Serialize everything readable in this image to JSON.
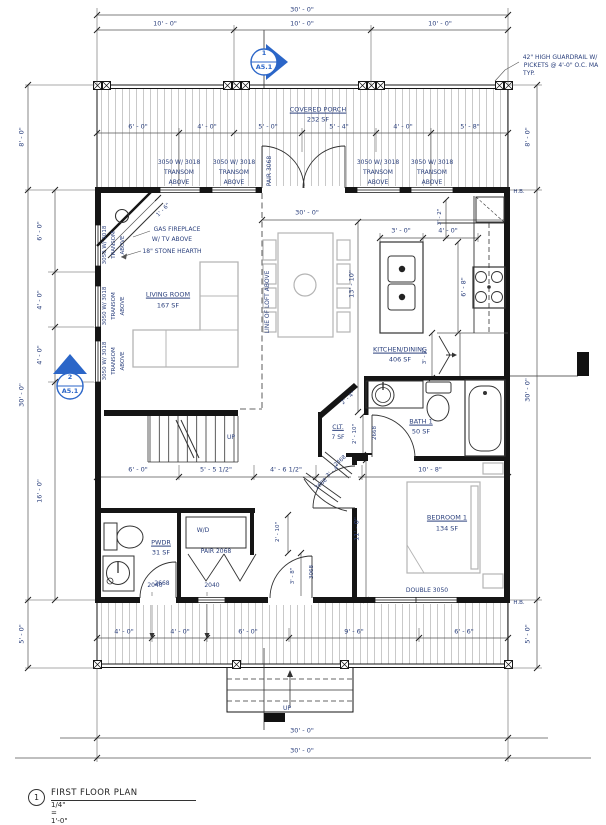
{
  "colors": {
    "annotation": "#2a3f7c",
    "marker_blue": "#2b66c8",
    "wall_black": "#151515",
    "furniture_gray": "#b4b4b4",
    "hatch_gray": "#a5a5a5"
  },
  "title_block": {
    "number": "1",
    "title": "FIRST FLOOR PLAN",
    "scale": "1/4\" = 1'-0\""
  },
  "section_markers": [
    {
      "number": "1",
      "sheet": "A5.1"
    },
    {
      "number": "2",
      "sheet": "A5.1"
    }
  ],
  "rooms": [
    {
      "name": "COVERED PORCH",
      "area": "232 SF"
    },
    {
      "name": "LIVING ROOM",
      "area": "167 SF"
    },
    {
      "name": "KITCHEN/DINING",
      "area": "406 SF"
    },
    {
      "name": "BATH 1",
      "area": "50 SF"
    },
    {
      "name": "CLT.",
      "area": "7 SF"
    },
    {
      "name": "PWDR",
      "area": "31 SF"
    },
    {
      "name": "BEDROOM 1",
      "area": "134 SF"
    }
  ],
  "labels": [
    {
      "n": "dim-top-overall",
      "t": "30' - 0\"",
      "x": 302,
      "y": 10
    },
    {
      "n": "dim-top-seg-1",
      "t": "10' - 0\"",
      "x": 165,
      "y": 24
    },
    {
      "n": "dim-top-seg-2",
      "t": "10' - 0\"",
      "x": 302,
      "y": 24
    },
    {
      "n": "dim-top-seg-3",
      "t": "10' - 0\"",
      "x": 440,
      "y": 24
    },
    {
      "n": "note-guardrail-1",
      "t": "42\" HIGH GUARDRAIL W/",
      "x": 560,
      "y": 58,
      "s": 6
    },
    {
      "n": "note-guardrail-2",
      "t": "PICKETS @ 4'-0\" O.C. MA",
      "x": 561,
      "y": 66,
      "s": 6
    },
    {
      "n": "note-guardrail-3",
      "t": "TYP.",
      "x": 529,
      "y": 74,
      "s": 6
    },
    {
      "n": "room-label-porch",
      "t": "COVERED PORCH",
      "x": 318,
      "y": 110,
      "u": 1
    },
    {
      "n": "room-area-porch",
      "t": "232 SF",
      "x": 318,
      "y": 120
    },
    {
      "n": "dim-porch-1",
      "t": "6' - 0\"",
      "x": 138,
      "y": 127
    },
    {
      "n": "dim-porch-2",
      "t": "4' - 0\"",
      "x": 207,
      "y": 127
    },
    {
      "n": "dim-porch-3",
      "t": "5' - 0\"",
      "x": 268,
      "y": 127
    },
    {
      "n": "dim-porch-4",
      "t": "5' - 4\"",
      "x": 339,
      "y": 127
    },
    {
      "n": "dim-porch-5",
      "t": "4' - 0\"",
      "x": 403,
      "y": 127
    },
    {
      "n": "dim-porch-6",
      "t": "5' - 8\"",
      "x": 470,
      "y": 127
    },
    {
      "n": "window-label-front-1a",
      "t": "3050 W/ 3018",
      "x": 179,
      "y": 163,
      "s": 6
    },
    {
      "n": "window-label-front-1b",
      "t": "TRANSOM",
      "x": 179,
      "y": 173,
      "s": 6
    },
    {
      "n": "window-label-front-1c",
      "t": "ABOVE",
      "x": 179,
      "y": 183,
      "s": 6
    },
    {
      "n": "window-label-front-2a",
      "t": "3050 W/ 3018",
      "x": 234,
      "y": 163,
      "s": 6
    },
    {
      "n": "window-label-front-2b",
      "t": "TRANSOM",
      "x": 234,
      "y": 173,
      "s": 6
    },
    {
      "n": "window-label-front-2c",
      "t": "ABOVE",
      "x": 234,
      "y": 183,
      "s": 6
    },
    {
      "n": "door-tag-pair-3068",
      "t": "PAIR 3068",
      "x": 270,
      "y": 171,
      "r": -90,
      "s": 6
    },
    {
      "n": "window-label-front-3a",
      "t": "3050 W/ 3018",
      "x": 378,
      "y": 163,
      "s": 6
    },
    {
      "n": "window-label-front-3b",
      "t": "TRANSOM",
      "x": 378,
      "y": 173,
      "s": 6
    },
    {
      "n": "window-label-front-3c",
      "t": "ABOVE",
      "x": 378,
      "y": 183,
      "s": 6
    },
    {
      "n": "window-label-front-4a",
      "t": "3050 W/ 3018",
      "x": 432,
      "y": 163,
      "s": 6
    },
    {
      "n": "window-label-front-4b",
      "t": "TRANSOM",
      "x": 432,
      "y": 173,
      "s": 6
    },
    {
      "n": "window-label-front-4c",
      "t": "ABOVE",
      "x": 432,
      "y": 183,
      "s": 6
    },
    {
      "n": "dim-left-porch",
      "t": "8' - 0\"",
      "x": 22,
      "y": 137,
      "r": -90
    },
    {
      "n": "dim-left-overall",
      "t": "30' - 0\"",
      "x": 22,
      "y": 395,
      "r": -90
    },
    {
      "n": "dim-left-deck",
      "t": "5' - 0\"",
      "x": 22,
      "y": 634,
      "r": -90
    },
    {
      "n": "dim-left-seg-1",
      "t": "6' - 0\"",
      "x": 40,
      "y": 231,
      "r": -90
    },
    {
      "n": "dim-left-seg-2",
      "t": "4' - 0\"",
      "x": 40,
      "y": 300,
      "r": -90
    },
    {
      "n": "dim-left-seg-3",
      "t": "4' - 0\"",
      "x": 40,
      "y": 355,
      "r": -90
    },
    {
      "n": "dim-left-seg-4",
      "t": "16' - 0\"",
      "x": 40,
      "y": 491,
      "r": -90
    },
    {
      "n": "window-label-left-1a",
      "t": "3050 W/ 3018",
      "x": 106,
      "y": 245,
      "r": -90,
      "s": 5.5
    },
    {
      "n": "window-label-left-1b",
      "t": "TRANSOM",
      "x": 115,
      "y": 245,
      "r": -90,
      "s": 5.5
    },
    {
      "n": "window-label-left-1c",
      "t": "ABOVE",
      "x": 124,
      "y": 245,
      "r": -90,
      "s": 5.5
    },
    {
      "n": "window-label-left-2a",
      "t": "3050 W/ 3018",
      "x": 106,
      "y": 306,
      "r": -90,
      "s": 5.5
    },
    {
      "n": "window-label-left-2b",
      "t": "TRANSOM",
      "x": 115,
      "y": 306,
      "r": -90,
      "s": 5.5
    },
    {
      "n": "window-label-left-2c",
      "t": "ABOVE",
      "x": 124,
      "y": 306,
      "r": -90,
      "s": 5.5
    },
    {
      "n": "window-label-left-3a",
      "t": "3050 W/ 3018",
      "x": 106,
      "y": 361,
      "r": -90,
      "s": 5.5
    },
    {
      "n": "window-label-left-3b",
      "t": "TRANSOM",
      "x": 115,
      "y": 361,
      "r": -90,
      "s": 5.5
    },
    {
      "n": "window-label-left-3c",
      "t": "ABOVE",
      "x": 124,
      "y": 361,
      "r": -90,
      "s": 5.5
    },
    {
      "n": "dim-right-porch",
      "t": "8' - 0\"",
      "x": 528,
      "y": 137,
      "r": -90
    },
    {
      "n": "dim-right-overall",
      "t": "30' - 0\"",
      "x": 528,
      "y": 390,
      "r": -90
    },
    {
      "n": "dim-right-deck",
      "t": "5' - 0\"",
      "x": 528,
      "y": 634,
      "r": -90
    },
    {
      "n": "hose-bib-top",
      "t": "H.B.",
      "x": 519,
      "y": 193,
      "s": 5.5
    },
    {
      "n": "hose-bib-bottom",
      "t": "H.B.",
      "x": 519,
      "y": 604,
      "s": 5.5
    },
    {
      "n": "note-fireplace-1",
      "t": "GAS FIREPLACE",
      "x": 177,
      "y": 230,
      "s": 6
    },
    {
      "n": "note-fireplace-2",
      "t": "W/ TV ABOVE",
      "x": 172,
      "y": 240,
      "s": 6
    },
    {
      "n": "note-hearth",
      "t": "18\" STONE HEARTH",
      "x": 172,
      "y": 252,
      "s": 6
    },
    {
      "n": "dim-hearth",
      "t": "1' - 6\"",
      "x": 164,
      "y": 211,
      "r": -45,
      "s": 5.5
    },
    {
      "n": "room-label-living",
      "t": "LIVING ROOM",
      "x": 168,
      "y": 295,
      "u": 1
    },
    {
      "n": "room-area-living",
      "t": "167 SF",
      "x": 168,
      "y": 306
    },
    {
      "n": "note-loft-line",
      "t": "LINE OF LOFT ABOVE",
      "x": 268,
      "y": 302,
      "r": -90,
      "s": 6
    },
    {
      "n": "dim-interior-width",
      "t": "30' - 0\"",
      "x": 307,
      "y": 213
    },
    {
      "n": "dim-kitchen-length",
      "t": "13' - 10\"",
      "x": 352,
      "y": 284,
      "r": -90
    },
    {
      "n": "dim-island-width",
      "t": "3' - 0\"",
      "x": 401,
      "y": 231
    },
    {
      "n": "dim-counter-small",
      "t": "3' - 2\"",
      "x": 441,
      "y": 217,
      "r": -90,
      "s": 5.5
    },
    {
      "n": "dim-counter-clear",
      "t": "4' - 0\"",
      "x": 448,
      "y": 231
    },
    {
      "n": "dim-island-length",
      "t": "6' - 8\"",
      "x": 464,
      "y": 287,
      "r": -90
    },
    {
      "n": "room-label-kitchen",
      "t": "KITCHEN/DINING",
      "x": 400,
      "y": 350,
      "u": 1
    },
    {
      "n": "room-area-kitchen",
      "t": "406 SF",
      "x": 400,
      "y": 360
    },
    {
      "n": "dim-pantry",
      "t": "3' - 2\"",
      "x": 426,
      "y": 356,
      "r": -90,
      "s": 5.5
    },
    {
      "n": "room-label-bath",
      "t": "BATH 1",
      "x": 421,
      "y": 422,
      "u": 1
    },
    {
      "n": "room-area-bath",
      "t": "50 SF",
      "x": 421,
      "y": 432
    },
    {
      "n": "door-tag-bath",
      "t": "2668",
      "x": 376,
      "y": 433,
      "r": -90,
      "s": 5.5
    },
    {
      "n": "room-label-clt",
      "t": "CLT.",
      "x": 338,
      "y": 428,
      "u": 1,
      "s": 6
    },
    {
      "n": "room-area-clt",
      "t": "7 SF",
      "x": 338,
      "y": 438,
      "s": 6
    },
    {
      "n": "dim-clt-depth",
      "t": "2' - 10\"",
      "x": 356,
      "y": 434,
      "r": -90,
      "s": 5.5
    },
    {
      "n": "dim-clt-diag",
      "t": "2' - 4\"",
      "x": 349,
      "y": 399,
      "r": -42,
      "s": 5.5
    },
    {
      "n": "door-tag-clt",
      "t": "2468",
      "x": 341,
      "y": 462,
      "r": -42,
      "s": 5.5
    },
    {
      "n": "dim-clt-door",
      "t": "3' - 4\"",
      "x": 334,
      "y": 472,
      "r": -42,
      "s": 5.5
    },
    {
      "n": "door-tag-vestibule",
      "t": "2668",
      "x": 322,
      "y": 485,
      "r": -42,
      "s": 5.5
    },
    {
      "n": "stairs-up",
      "t": "UP",
      "x": 231,
      "y": 438,
      "s": 6
    },
    {
      "n": "dim-hall-1",
      "t": "6' - 0\"",
      "x": 138,
      "y": 470
    },
    {
      "n": "dim-hall-2",
      "t": "5' - 5 1/2\"",
      "x": 216,
      "y": 470
    },
    {
      "n": "dim-hall-3",
      "t": "4' - 6 1/2\"",
      "x": 286,
      "y": 470
    },
    {
      "n": "dim-bath-width",
      "t": "10' - 8\"",
      "x": 430,
      "y": 470
    },
    {
      "n": "room-label-pwdr",
      "t": "PWDR",
      "x": 161,
      "y": 543,
      "u": 1
    },
    {
      "n": "room-area-pwdr",
      "t": "31 SF",
      "x": 161,
      "y": 553
    },
    {
      "n": "appliance-wd",
      "t": "W/D",
      "x": 203,
      "y": 531,
      "s": 6
    },
    {
      "n": "door-tag-pair-2068",
      "t": "PAIR 2068",
      "x": 216,
      "y": 552,
      "s": 6
    },
    {
      "n": "door-tag-pwdr",
      "t": "2668",
      "x": 162,
      "y": 584,
      "s": 6
    },
    {
      "n": "dim-wd-depth",
      "t": "2' - 10\"",
      "x": 279,
      "y": 532,
      "r": -90,
      "s": 5.5
    },
    {
      "n": "dim-rear-door",
      "t": "3' - 8\"",
      "x": 294,
      "y": 576,
      "r": -90,
      "s": 5.5
    },
    {
      "n": "door-tag-rear",
      "t": "3068",
      "x": 313,
      "y": 572,
      "r": -90,
      "s": 5.5
    },
    {
      "n": "dim-bedroom-depth",
      "t": "11' - 0\"",
      "x": 357,
      "y": 529,
      "r": -90
    },
    {
      "n": "room-label-bedroom",
      "t": "BEDROOM 1",
      "x": 447,
      "y": 518,
      "u": 1
    },
    {
      "n": "room-area-bedroom",
      "t": "134 SF",
      "x": 447,
      "y": 529
    },
    {
      "n": "window-label-double-3050",
      "t": "DOUBLE 3050",
      "x": 427,
      "y": 591,
      "s": 6
    },
    {
      "n": "window-label-2040-a",
      "t": "2040",
      "x": 155,
      "y": 586,
      "s": 6
    },
    {
      "n": "window-label-2040-b",
      "t": "2040",
      "x": 212,
      "y": 586,
      "s": 6
    },
    {
      "n": "dim-deck-1",
      "t": "4' - 0\"",
      "x": 124,
      "y": 632
    },
    {
      "n": "dim-deck-2",
      "t": "4' - 0\"",
      "x": 180,
      "y": 632
    },
    {
      "n": "dim-deck-3",
      "t": "6' - 0\"",
      "x": 248,
      "y": 632
    },
    {
      "n": "dim-deck-4",
      "t": "9' - 6\"",
      "x": 354,
      "y": 632
    },
    {
      "n": "dim-deck-5",
      "t": "6' - 6\"",
      "x": 464,
      "y": 632
    },
    {
      "n": "steps-up",
      "t": "UP",
      "x": 287,
      "y": 709,
      "s": 6
    },
    {
      "n": "dim-bottom-1",
      "t": "30' - 0\"",
      "x": 302,
      "y": 731
    },
    {
      "n": "dim-bottom-2",
      "t": "30' - 0\"",
      "x": 302,
      "y": 751
    }
  ]
}
